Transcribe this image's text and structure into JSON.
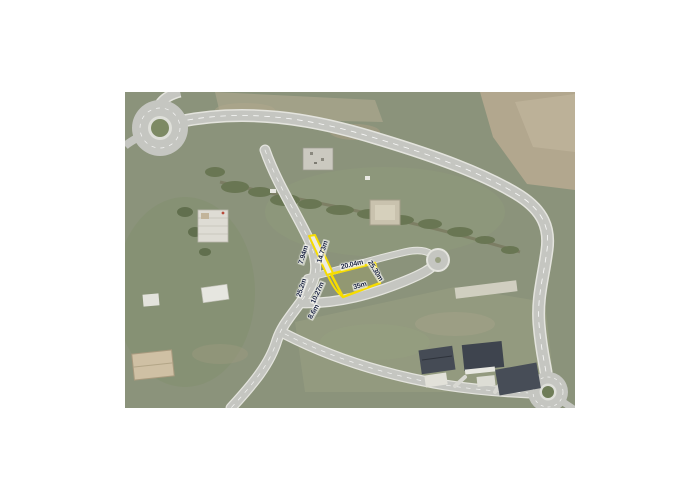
{
  "page": {
    "background": "#ffffff"
  },
  "map": {
    "type": "aerial-photo",
    "description": "Aerial photo of a suburban development with a highlighted building plot",
    "highlight_color": "#f6dc00",
    "label_color": "#1b2440",
    "terrain_color": "#8b937b",
    "road_color": "#c5c6c1",
    "dirt_color": "#b2a78e",
    "roof_color": "#424851"
  },
  "measurements": [
    {
      "text": "7.94m"
    },
    {
      "text": "14.73m"
    },
    {
      "text": "25.2m"
    },
    {
      "text": "10.27m"
    },
    {
      "text": "8.6m"
    },
    {
      "text": "20.04m"
    },
    {
      "text": "35m"
    },
    {
      "text": "25.30m"
    }
  ]
}
